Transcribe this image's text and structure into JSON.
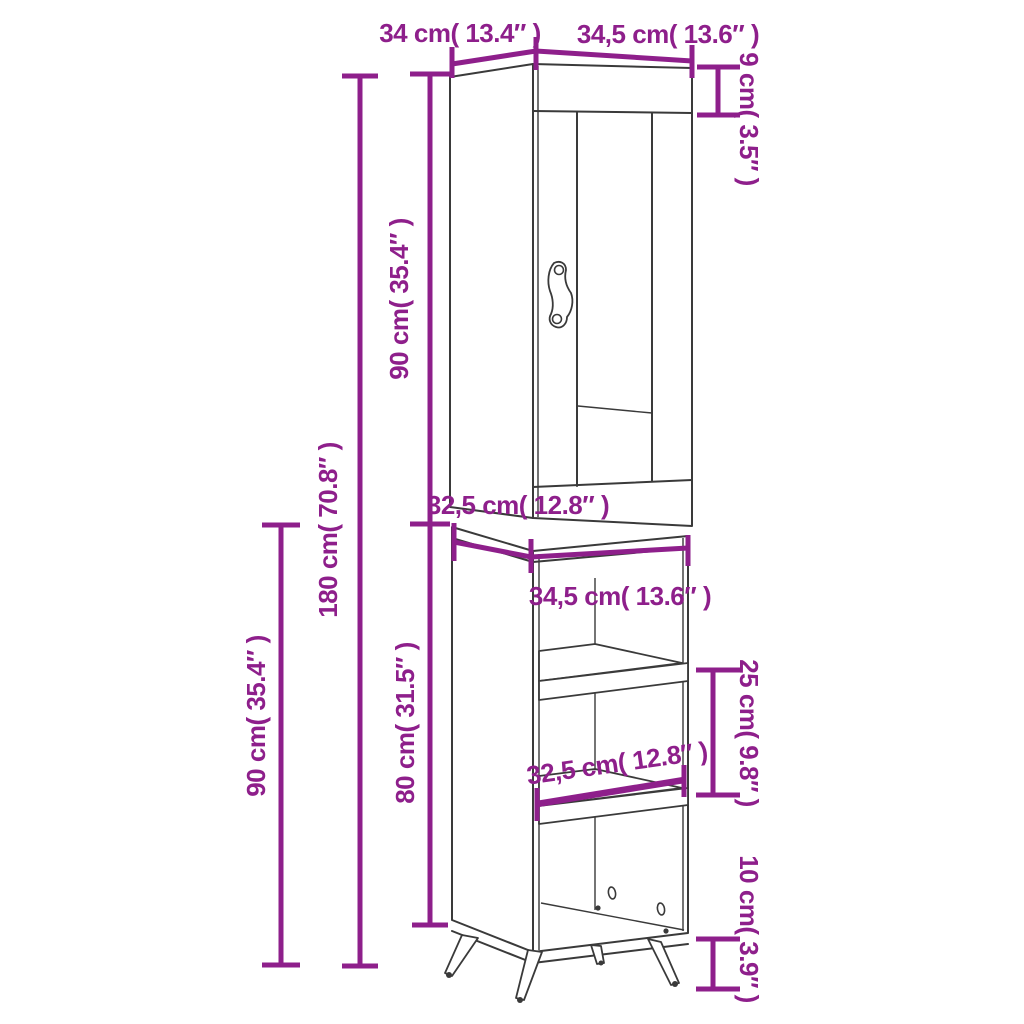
{
  "diagram": {
    "type": "furniture-dimension-diagram",
    "subject": "tall highboard cabinet with glass door, open shelves and splayed legs",
    "colors": {
      "dimension_accent": "#8E1F8B",
      "outline": "#3a3a3a",
      "background": "#ffffff"
    },
    "dim_labels": {
      "top_depth": "34 cm( 13.4″ )",
      "top_width": "34,5 cm( 13.6″ )",
      "cornice_height": "9 cm( 3.5″ )",
      "upper_unit_height": "90 cm( 35.4″ )",
      "total_height": "180 cm( 70.8″ )",
      "lower_half_height": "90 cm( 35.4″ )",
      "base_depth": "32,5 cm( 12.8″ )",
      "base_width": "34,5 cm( 13.6″ )",
      "base_unit_height": "80 cm( 31.5″ )",
      "compartment_height": "25 cm( 9.8″ )",
      "shelf_depth": "32,5 cm( 12.8″ )",
      "leg_height": "10 cm( 3.9″ )"
    }
  }
}
